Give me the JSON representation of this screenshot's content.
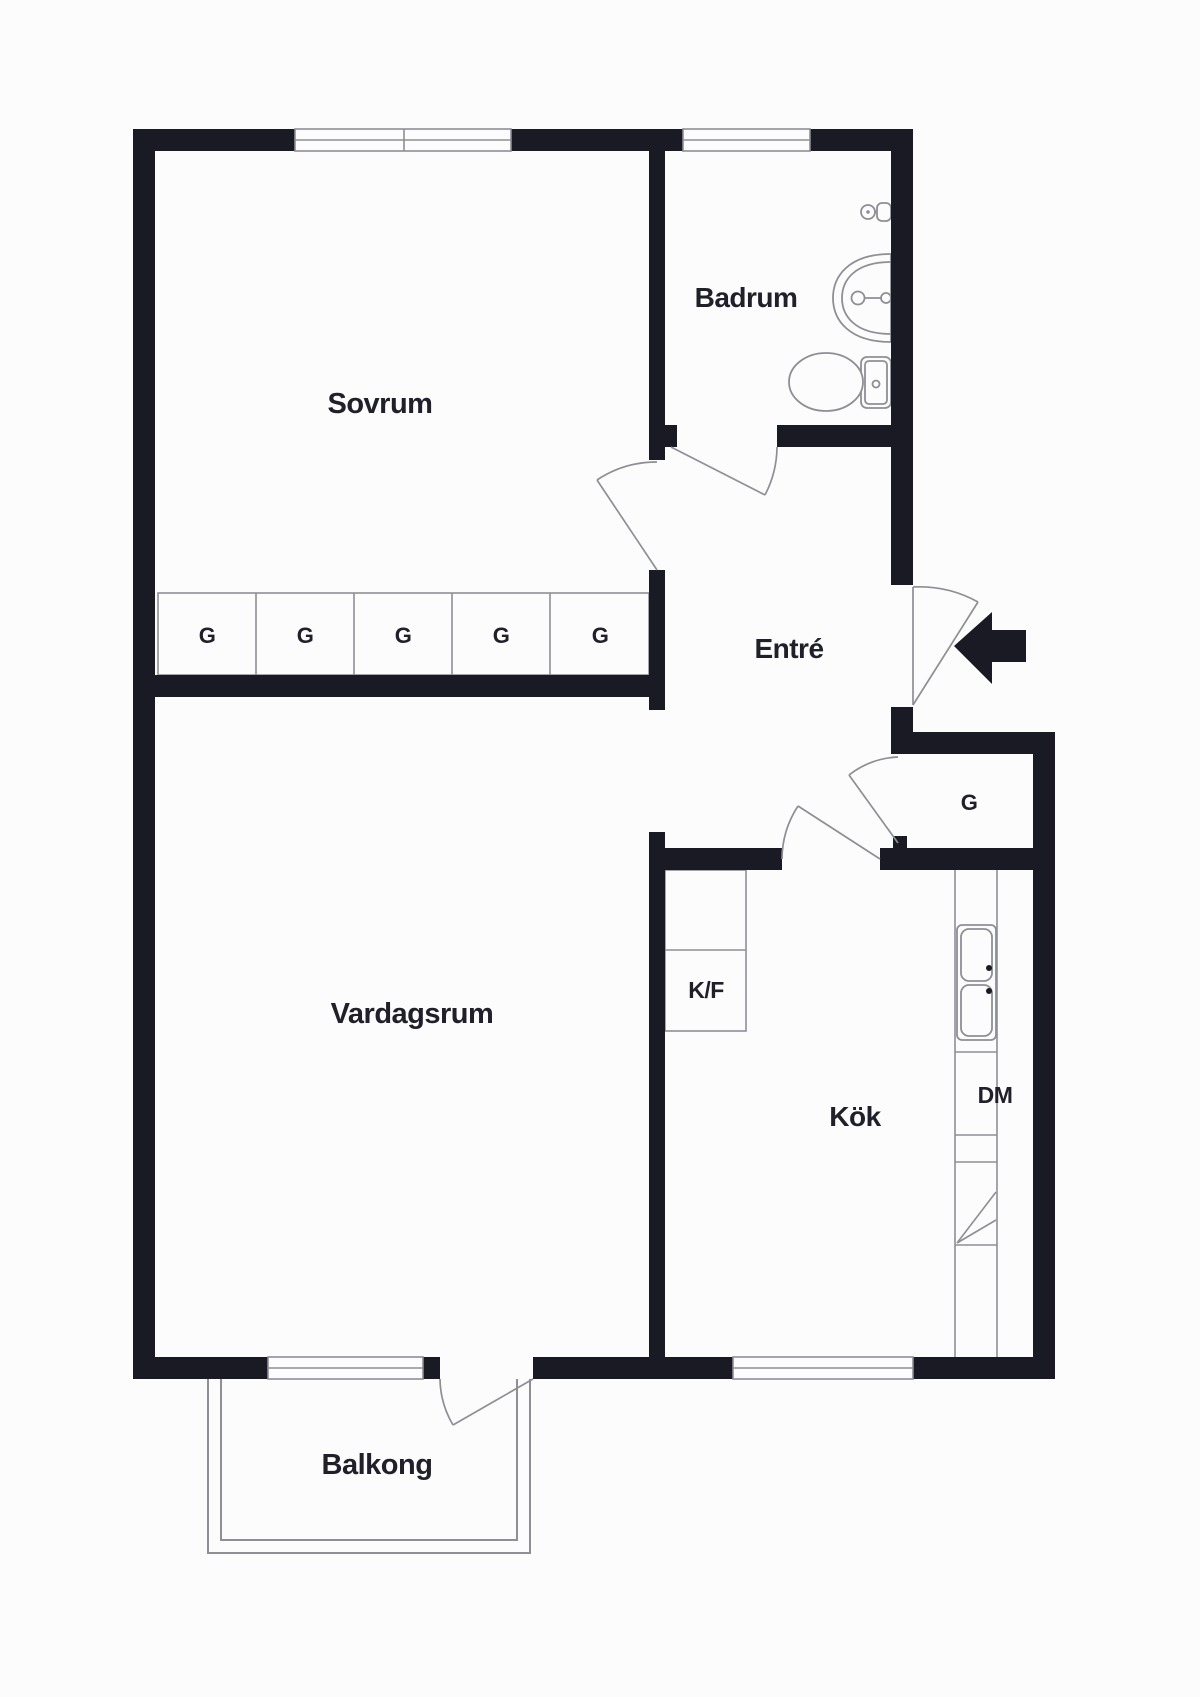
{
  "document": {
    "type": "apartment floor plan",
    "language": "Swedish"
  },
  "colors": {
    "background": "#fcfcfc",
    "wall": "#1a1a24",
    "thin_line": "#8e8e95",
    "text": "#20202a",
    "fixture_fill": "#fcfcfc"
  },
  "rooms": {
    "bedroom": "Sovrum",
    "bathroom": "Badrum",
    "entry": "Entré",
    "living_room": "Vardagsrum",
    "kitchen": "Kök",
    "balcony": "Balkong"
  },
  "fixtures": {
    "wardrobes": [
      "G",
      "G",
      "G",
      "G",
      "G"
    ],
    "hall_wardrobe": "G",
    "fridge_freezer": "K/F",
    "dishwasher": "DM"
  }
}
